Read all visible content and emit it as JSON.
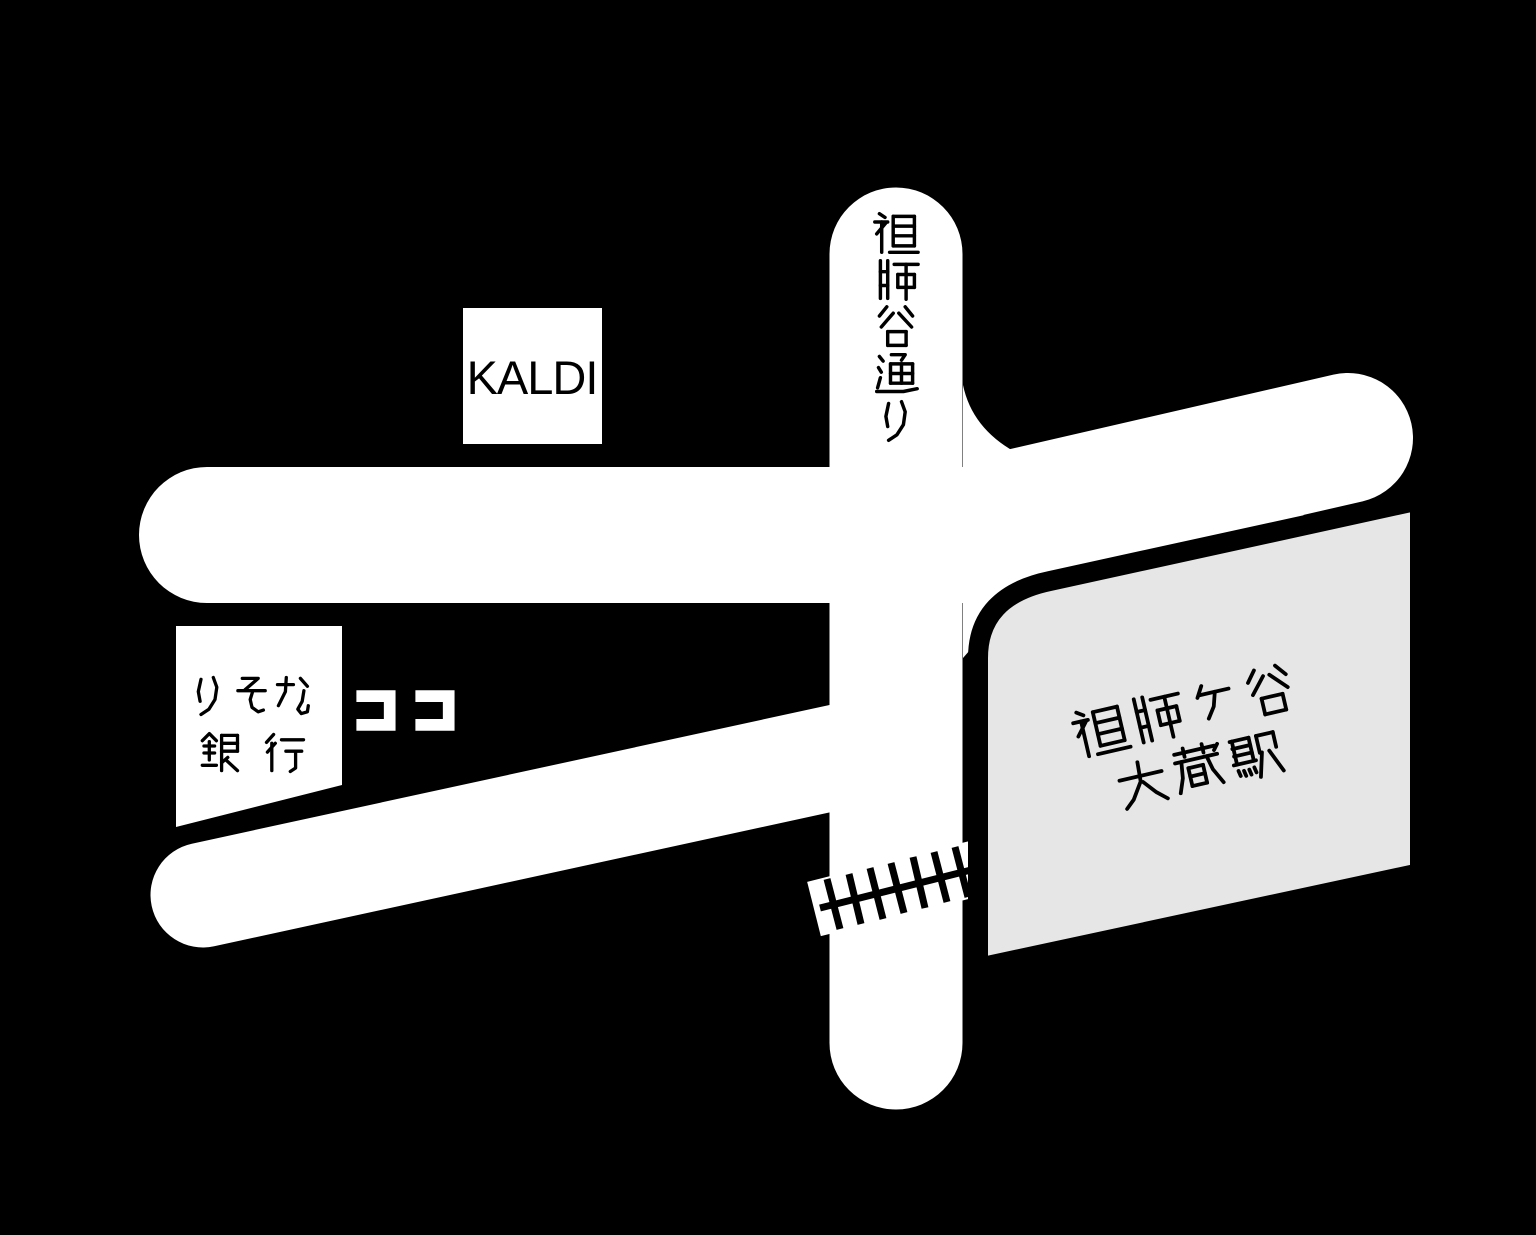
{
  "map": {
    "colors": {
      "background": "#000000",
      "road": "#ffffff",
      "station_fill": "#e6e6e6",
      "station_outline": "#000000",
      "text": "#000000",
      "here_text": "#ffffff",
      "railway": "#000000"
    },
    "labels": {
      "street": {
        "text": "祖師谷通り"
      },
      "kaldi": {
        "text": "KALDI"
      },
      "bank": {
        "line1": "りそな",
        "line2": "銀 行"
      },
      "here": {
        "text": "ココ"
      },
      "station": {
        "line1": "祖師ヶ谷",
        "line2": "大蔵駅"
      }
    }
  }
}
